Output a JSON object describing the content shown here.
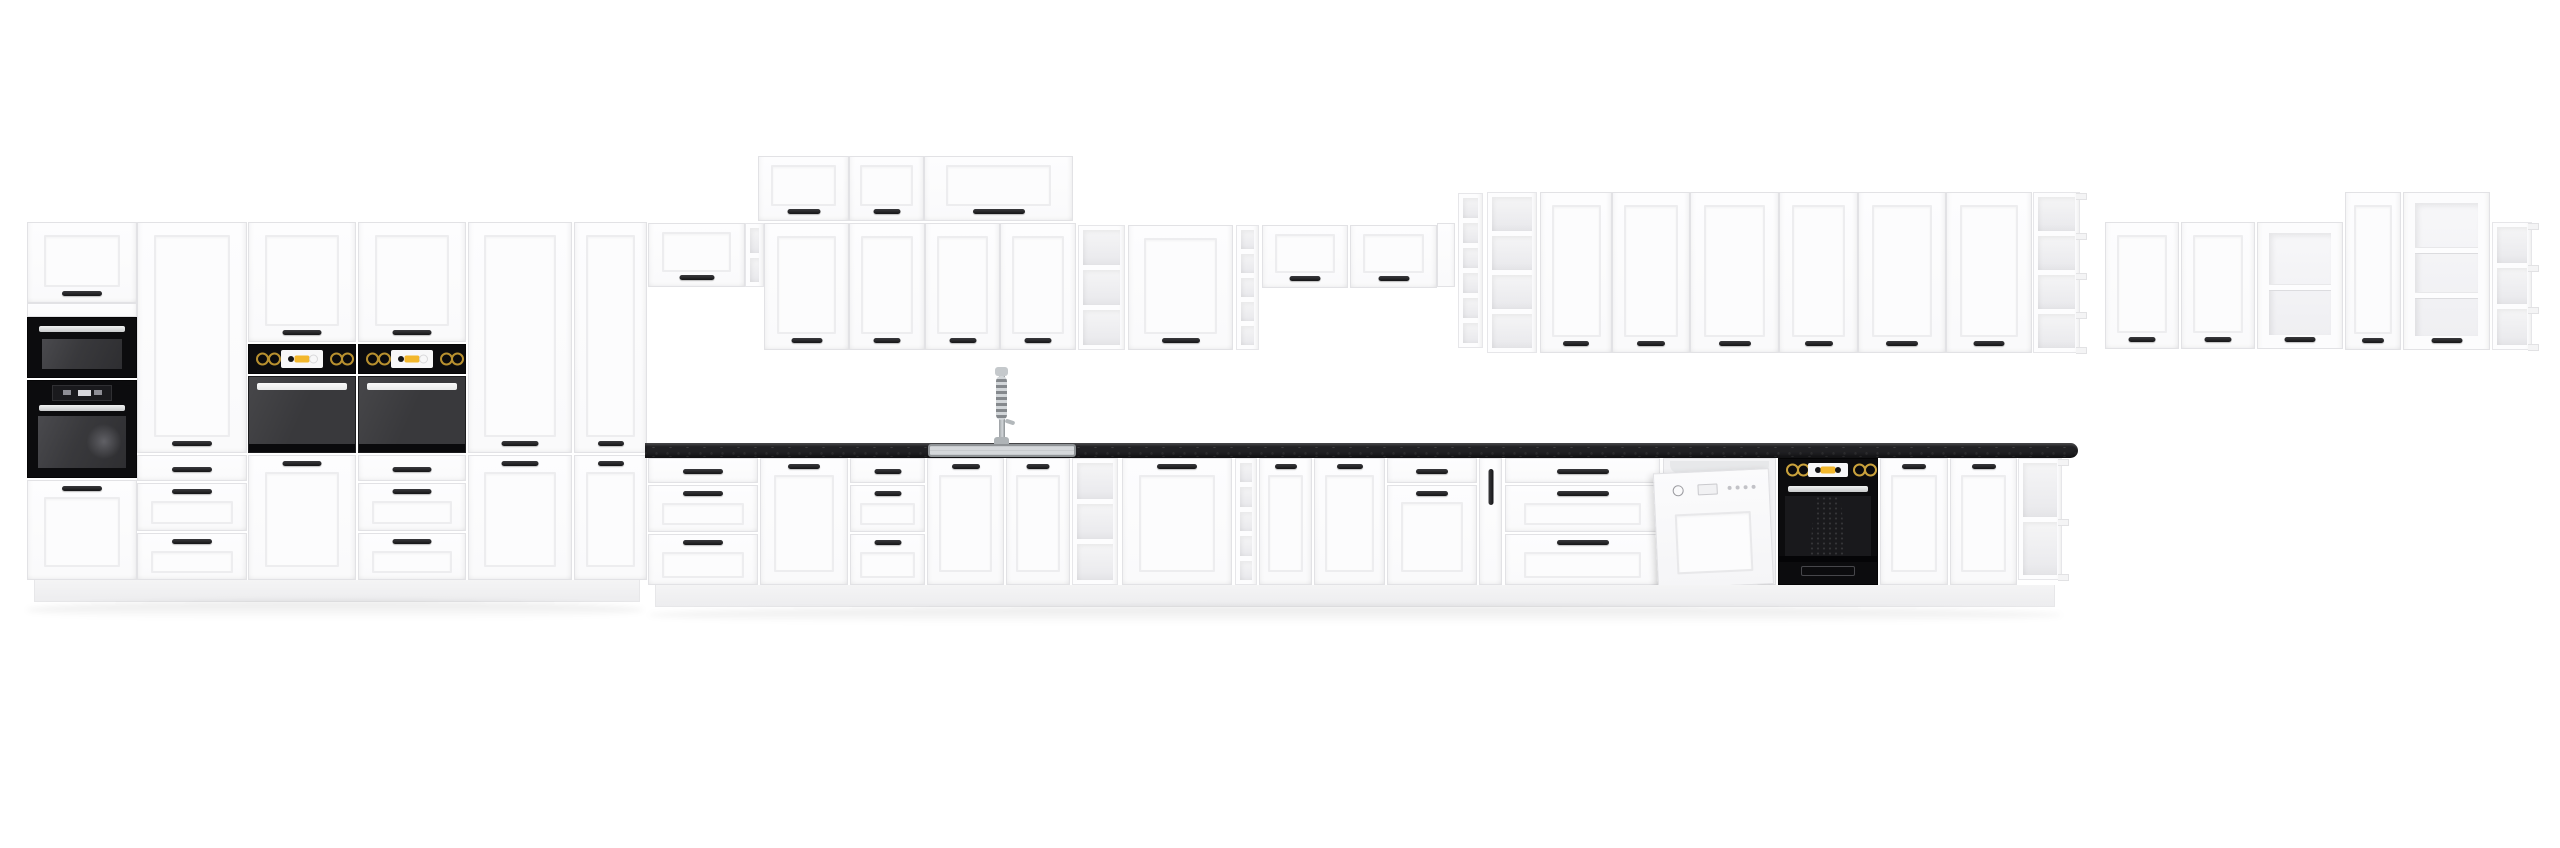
{
  "scene": {
    "description": "white-shaker-kitchen-cabinet-set-with-black-worktop-and-appliances",
    "canvas": {
      "width": 2560,
      "height": 848
    },
    "palette": {
      "background": "#ffffff",
      "cabinet_white": "#fbfbfc",
      "cabinet_border": "#e2e2e5",
      "panel_line": "#ededef",
      "handle_black": "#1d1d1f",
      "worktop_black": "#212124",
      "appliance_black": "#0c0c0e",
      "oven_window_gray": "#39393c",
      "steel": "#d6d8da",
      "sink_steel": "#d5d8db",
      "knob_gold": "#b8902f",
      "display_white": "#f7f7f8",
      "accent_yellow": "#f2b72c",
      "shelf_interior": "#efeff1",
      "plinth": "#f2f2f4"
    },
    "counts": {
      "tall_units": 6,
      "wall_units": 22,
      "base_units": 16,
      "appliances": 6,
      "open_shelf_units": 9
    }
  },
  "modules": [
    {
      "name": "tall-column-top-door",
      "type": "door",
      "x": 27,
      "y": 222,
      "w": 110,
      "h": 81,
      "handle": "bottom"
    },
    {
      "name": "filler-strip",
      "type": "panel",
      "x": 27,
      "y": 303,
      "w": 110,
      "h": 14
    },
    {
      "name": "microwave",
      "type": "microwave",
      "x": 27,
      "y": 317,
      "w": 110,
      "h": 61
    },
    {
      "name": "built-in-oven-tall",
      "type": "ovenTall",
      "x": 27,
      "y": 380,
      "w": 110,
      "h": 98
    },
    {
      "name": "tall-column-bottom-door",
      "type": "door",
      "x": 27,
      "y": 480,
      "w": 110,
      "h": 100,
      "handle": "top"
    },
    {
      "name": "pantry-large-door",
      "type": "door",
      "x": 137,
      "y": 222,
      "w": 110,
      "h": 231,
      "handle": "bottom"
    },
    {
      "name": "drawer",
      "type": "drawer",
      "x": 137,
      "y": 455,
      "w": 110,
      "h": 26,
      "panel": false
    },
    {
      "name": "drawer",
      "type": "drawer",
      "x": 137,
      "y": 483,
      "w": 110,
      "h": 48,
      "panel": true
    },
    {
      "name": "drawer",
      "type": "drawer",
      "x": 137,
      "y": 533,
      "w": 110,
      "h": 47,
      "panel": true
    },
    {
      "name": "oven-housing-1-top-door",
      "type": "door",
      "x": 248,
      "y": 222,
      "w": 108,
      "h": 120,
      "handle": "bottom"
    },
    {
      "name": "oven-control-panel",
      "type": "ovenControl",
      "x": 248,
      "y": 344,
      "w": 108,
      "h": 30
    },
    {
      "name": "built-in-oven",
      "type": "ovenMid",
      "x": 248,
      "y": 376,
      "w": 108,
      "h": 77
    },
    {
      "name": "oven-housing-1-bottom-door",
      "type": "door",
      "x": 248,
      "y": 455,
      "w": 108,
      "h": 125,
      "handle": "top"
    },
    {
      "name": "oven-housing-2-top-door",
      "type": "door",
      "x": 358,
      "y": 222,
      "w": 108,
      "h": 120,
      "handle": "bottom"
    },
    {
      "name": "oven-control-panel",
      "type": "ovenControl",
      "x": 358,
      "y": 344,
      "w": 108,
      "h": 30
    },
    {
      "name": "built-in-oven",
      "type": "ovenMid",
      "x": 358,
      "y": 376,
      "w": 108,
      "h": 77
    },
    {
      "name": "drawer",
      "type": "drawer",
      "x": 358,
      "y": 455,
      "w": 108,
      "h": 26,
      "panel": false
    },
    {
      "name": "drawer",
      "type": "drawer",
      "x": 358,
      "y": 483,
      "w": 108,
      "h": 48,
      "panel": true
    },
    {
      "name": "drawer",
      "type": "drawer",
      "x": 358,
      "y": 533,
      "w": 108,
      "h": 47,
      "panel": true
    },
    {
      "name": "pantry-upper-door",
      "type": "door",
      "x": 468,
      "y": 222,
      "w": 104,
      "h": 231,
      "handle": "bottom"
    },
    {
      "name": "pantry-lower-door",
      "type": "door",
      "x": 468,
      "y": 455,
      "w": 104,
      "h": 125,
      "handle": "top"
    },
    {
      "name": "pantry-upper-door",
      "type": "door",
      "x": 574,
      "y": 222,
      "w": 73,
      "h": 231,
      "handle": "bottom"
    },
    {
      "name": "pantry-lower-door",
      "type": "door",
      "x": 574,
      "y": 455,
      "w": 73,
      "h": 125,
      "handle": "top"
    },
    {
      "name": "plinth-left",
      "type": "plinth",
      "x": 34,
      "y": 580,
      "w": 606,
      "h": 22
    },
    {
      "name": "floor-shadow",
      "type": "shadow",
      "x": 26,
      "y": 601,
      "w": 618,
      "h": 18
    },
    {
      "name": "wall-cabinet-door",
      "type": "door",
      "x": 648,
      "y": 223,
      "w": 97,
      "h": 64,
      "handle": "bottom"
    },
    {
      "name": "wall-end-shelf",
      "type": "shelf",
      "x": 745,
      "y": 223,
      "w": 19,
      "h": 64,
      "comps": 2
    },
    {
      "name": "top-box-door",
      "type": "door",
      "x": 758,
      "y": 156,
      "w": 91,
      "h": 65,
      "handle": "bottom"
    },
    {
      "name": "top-box-door",
      "type": "door",
      "x": 849,
      "y": 156,
      "w": 75,
      "h": 65,
      "handle": "bottom"
    },
    {
      "name": "top-box-door-wide",
      "type": "door",
      "x": 924,
      "y": 156,
      "w": 149,
      "h": 65,
      "handle": "bottom"
    },
    {
      "name": "wall-door",
      "type": "door",
      "x": 764,
      "y": 223,
      "w": 85,
      "h": 127,
      "handle": "bottom"
    },
    {
      "name": "wall-door",
      "type": "door",
      "x": 849,
      "y": 223,
      "w": 76,
      "h": 127,
      "handle": "bottom"
    },
    {
      "name": "wall-door",
      "type": "door",
      "x": 925,
      "y": 223,
      "w": 75,
      "h": 127,
      "handle": "bottom"
    },
    {
      "name": "wall-door",
      "type": "door",
      "x": 1000,
      "y": 223,
      "w": 76,
      "h": 127,
      "handle": "bottom"
    },
    {
      "name": "open-shelf",
      "type": "shelf",
      "x": 1078,
      "y": 225,
      "w": 47,
      "h": 125,
      "comps": 3
    },
    {
      "name": "wall-door",
      "type": "door",
      "x": 1128,
      "y": 225,
      "w": 105,
      "h": 125,
      "handle": "bottom"
    },
    {
      "name": "narrow-open-shelf",
      "type": "shelf",
      "x": 1236,
      "y": 225,
      "w": 23,
      "h": 125,
      "comps": 5
    },
    {
      "name": "wall-lift-door",
      "type": "door",
      "x": 1262,
      "y": 225,
      "w": 86,
      "h": 63,
      "handle": "bottom"
    },
    {
      "name": "wall-lift-door",
      "type": "door",
      "x": 1350,
      "y": 225,
      "w": 87,
      "h": 63,
      "handle": "bottom"
    },
    {
      "name": "side-panel",
      "type": "panel",
      "x": 1437,
      "y": 223,
      "w": 18,
      "h": 64
    },
    {
      "name": "narrow-open-shelf",
      "type": "shelf",
      "x": 1458,
      "y": 193,
      "w": 25,
      "h": 155,
      "comps": 6
    },
    {
      "name": "open-shelf",
      "type": "shelf",
      "x": 1487,
      "y": 192,
      "w": 50,
      "h": 161,
      "comps": 4
    },
    {
      "name": "tall-wall-door",
      "type": "door",
      "x": 1540,
      "y": 192,
      "w": 72,
      "h": 161,
      "handle": "bottom"
    },
    {
      "name": "tall-wall-door",
      "type": "door",
      "x": 1612,
      "y": 192,
      "w": 78,
      "h": 161,
      "handle": "bottom"
    },
    {
      "name": "tall-wall-door",
      "type": "door",
      "x": 1690,
      "y": 192,
      "w": 89,
      "h": 161,
      "handle": "bottom"
    },
    {
      "name": "tall-wall-door",
      "type": "door",
      "x": 1779,
      "y": 192,
      "w": 79,
      "h": 161,
      "handle": "bottom"
    },
    {
      "name": "tall-wall-door",
      "type": "door",
      "x": 1858,
      "y": 192,
      "w": 88,
      "h": 161,
      "handle": "bottom"
    },
    {
      "name": "tall-wall-door",
      "type": "door",
      "x": 1946,
      "y": 192,
      "w": 86,
      "h": 161,
      "handle": "bottom"
    },
    {
      "name": "open-shelf-end",
      "type": "shelf",
      "x": 2033,
      "y": 192,
      "w": 47,
      "h": 161,
      "comps": 4,
      "lips": true
    },
    {
      "name": "wall-door",
      "type": "door",
      "x": 2105,
      "y": 222,
      "w": 74,
      "h": 127,
      "handle": "bottom"
    },
    {
      "name": "wall-door",
      "type": "door",
      "x": 2181,
      "y": 222,
      "w": 74,
      "h": 127,
      "handle": "bottom"
    },
    {
      "name": "glass-wall-door",
      "type": "glass",
      "x": 2257,
      "y": 222,
      "w": 86,
      "h": 127,
      "shelves": 1
    },
    {
      "name": "tall-wall-door",
      "type": "door",
      "x": 2345,
      "y": 192,
      "w": 56,
      "h": 158,
      "handle": "bottom"
    },
    {
      "name": "tall-glass-wall-door",
      "type": "glass",
      "x": 2403,
      "y": 192,
      "w": 87,
      "h": 158,
      "shelves": 2
    },
    {
      "name": "corner-open-shelf",
      "type": "shelf",
      "x": 2492,
      "y": 222,
      "w": 40,
      "h": 128,
      "comps": 3,
      "lips": true
    },
    {
      "name": "drawer",
      "type": "drawer",
      "x": 648,
      "y": 458,
      "w": 110,
      "h": 25,
      "panel": false
    },
    {
      "name": "drawer",
      "type": "drawer",
      "x": 648,
      "y": 485,
      "w": 110,
      "h": 47,
      "panel": true
    },
    {
      "name": "drawer",
      "type": "drawer",
      "x": 648,
      "y": 534,
      "w": 110,
      "h": 51,
      "panel": true
    },
    {
      "name": "base-door",
      "type": "door",
      "x": 760,
      "y": 458,
      "w": 88,
      "h": 127,
      "handle": "top"
    },
    {
      "name": "drawer",
      "type": "drawer",
      "x": 850,
      "y": 458,
      "w": 75,
      "h": 25,
      "panel": false
    },
    {
      "name": "drawer",
      "type": "drawer",
      "x": 850,
      "y": 485,
      "w": 75,
      "h": 47,
      "panel": true
    },
    {
      "name": "drawer",
      "type": "drawer",
      "x": 850,
      "y": 534,
      "w": 75,
      "h": 51,
      "panel": true
    },
    {
      "name": "sink-base-door",
      "type": "door",
      "x": 927,
      "y": 458,
      "w": 77,
      "h": 127,
      "handle": "top"
    },
    {
      "name": "sink-base-door",
      "type": "door",
      "x": 1006,
      "y": 458,
      "w": 64,
      "h": 127,
      "handle": "top"
    },
    {
      "name": "open-shelf",
      "type": "shelf",
      "x": 1072,
      "y": 458,
      "w": 46,
      "h": 127,
      "comps": 3
    },
    {
      "name": "base-door",
      "type": "door",
      "x": 1122,
      "y": 458,
      "w": 110,
      "h": 127,
      "handle": "top"
    },
    {
      "name": "narrow-open-shelf",
      "type": "shelf",
      "x": 1235,
      "y": 458,
      "w": 22,
      "h": 127,
      "comps": 5
    },
    {
      "name": "base-door",
      "type": "door",
      "x": 1259,
      "y": 458,
      "w": 53,
      "h": 127,
      "handle": "top"
    },
    {
      "name": "base-door",
      "type": "door",
      "x": 1314,
      "y": 458,
      "w": 71,
      "h": 127,
      "handle": "top"
    },
    {
      "name": "drawer",
      "type": "drawer",
      "x": 1387,
      "y": 458,
      "w": 90,
      "h": 25,
      "panel": false
    },
    {
      "name": "base-door",
      "type": "door",
      "x": 1387,
      "y": 485,
      "w": 90,
      "h": 100,
      "handle": "top"
    },
    {
      "name": "pullout-front",
      "type": "pullout",
      "x": 1479,
      "y": 458,
      "w": 23,
      "h": 127
    },
    {
      "name": "drawer",
      "type": "drawer",
      "x": 1505,
      "y": 458,
      "w": 155,
      "h": 25,
      "panel": false
    },
    {
      "name": "drawer",
      "type": "drawer",
      "x": 1505,
      "y": 485,
      "w": 155,
      "h": 47,
      "panel": true
    },
    {
      "name": "drawer",
      "type": "drawer",
      "x": 1505,
      "y": 534,
      "w": 155,
      "h": 51,
      "panel": true
    },
    {
      "name": "dishwasher",
      "type": "dishwasher",
      "x": 1663,
      "y": 458,
      "w": 113,
      "h": 127
    },
    {
      "name": "built-in-oven-base",
      "type": "ovenBase",
      "x": 1778,
      "y": 458,
      "w": 100,
      "h": 127
    },
    {
      "name": "base-door",
      "type": "door",
      "x": 1880,
      "y": 458,
      "w": 68,
      "h": 127,
      "handle": "top"
    },
    {
      "name": "base-door",
      "type": "door",
      "x": 1950,
      "y": 458,
      "w": 67,
      "h": 127,
      "handle": "top"
    },
    {
      "name": "base-end-shelf",
      "type": "shelf",
      "x": 2018,
      "y": 458,
      "w": 44,
      "h": 122,
      "comps": 2,
      "lips": true
    },
    {
      "name": "plinth-base",
      "type": "plinth",
      "x": 655,
      "y": 585,
      "w": 1400,
      "h": 22
    },
    {
      "name": "floor-shadow",
      "type": "shadow",
      "x": 648,
      "y": 606,
      "w": 1414,
      "h": 18
    },
    {
      "name": "worktop",
      "type": "worktop",
      "x": 645,
      "y": 443,
      "w": 1433,
      "h": 15
    },
    {
      "name": "sink",
      "type": "sink",
      "x": 928,
      "y": 444,
      "w": 148,
      "h": 13
    },
    {
      "name": "faucet",
      "type": "faucet",
      "x": 991,
      "y": 367,
      "w": 24,
      "h": 77
    }
  ]
}
